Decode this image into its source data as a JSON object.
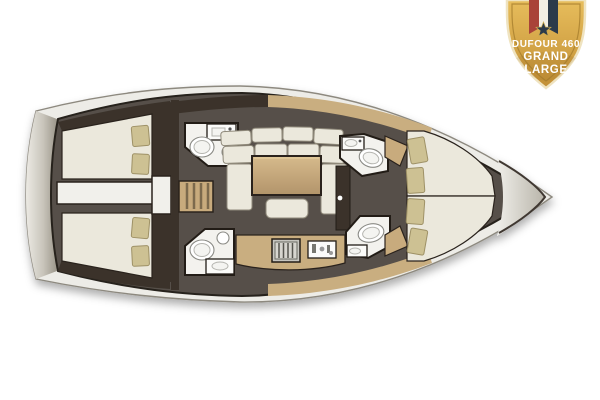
{
  "badge": {
    "model_line": "DUFOUR 460",
    "range_line1": "GRAND",
    "range_line2": "LARGE"
  },
  "palette": {
    "bg": "#ffffff",
    "rim": "#edece7",
    "rim-shade": "#9b968a",
    "hull-line": "#8d897f",
    "floor": "#57504a",
    "wall": "#3a332b",
    "wood": "#c8ab7d",
    "wood-light": "#c9ae80",
    "mattress": "#ebe8dc",
    "pillow": "#cdc193",
    "room": "#f3f2ee",
    "gold": "#e0b050",
    "gold-dark": "#c28f35",
    "ribbon-red": "#a94338",
    "ribbon-white": "#f2eee3",
    "ribbon-navy": "#2c3a4a",
    "badge-text": "#ffffff"
  },
  "floorplan": {
    "orientation": "bow-right",
    "areas": [
      "aft-cabin-port",
      "aft-cabin-starboard",
      "head-aft-port",
      "head-aft-starboard",
      "companionway-steps",
      "saloon-settee",
      "saloon-table",
      "galley",
      "head-forward-port",
      "head-forward-starboard",
      "forward-cabin",
      "anchor-locker"
    ]
  }
}
